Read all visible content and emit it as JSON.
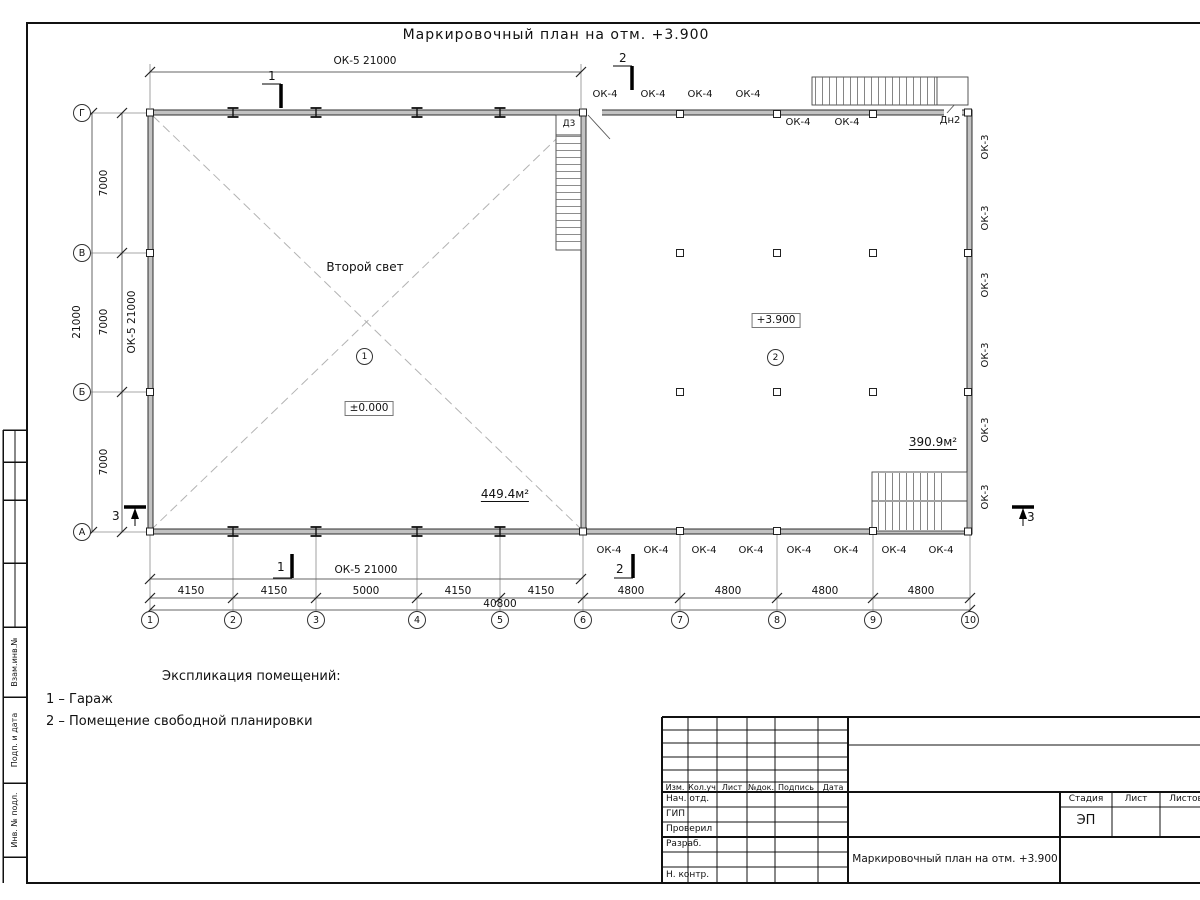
{
  "page_title": "Маркировочный план на отм. +3.900",
  "plan": {
    "axes_rows": [
      "Г",
      "В",
      "Б",
      "А"
    ],
    "axes_cols": [
      "1",
      "2",
      "3",
      "4",
      "5",
      "6",
      "7",
      "8",
      "9",
      "10"
    ],
    "dims": {
      "top_span": "ОК-5 21000",
      "bottom_span": "ОК-5 21000",
      "left_wall_mark": "ОК-5 21000",
      "left_total": "21000",
      "left_segments": [
        "7000",
        "7000",
        "7000"
      ],
      "bottom_segments": [
        "4150",
        "4150",
        "5000",
        "4150",
        "4150",
        "4800",
        "4800",
        "4800",
        "4800"
      ],
      "bottom_total": "40800"
    },
    "sections": {
      "one": "1",
      "two": "2",
      "three": "3"
    },
    "marks": {
      "ok4": "ОК-4",
      "ok3": "ОК-3",
      "d3": "Д3",
      "dn2": "Дн2"
    },
    "rooms": [
      {
        "number": "1",
        "note": "Второй свет",
        "elevation": "±0.000",
        "area": "449.4м²"
      },
      {
        "number": "2",
        "elevation": "+3.900",
        "area": "390.9м²"
      }
    ]
  },
  "legend": {
    "title": "Экспликация помещений:",
    "items": [
      "1 – Гараж",
      "2 – Помещение свободной планировки"
    ]
  },
  "titleblock": {
    "header_cols": [
      "Изм.",
      "Кол.уч",
      "Лист",
      "№док.",
      "Подпись",
      "Дата"
    ],
    "sign_rows": [
      "Нач. отд.",
      "ГИП",
      "Проверил",
      "Разраб.",
      "Н. контр."
    ],
    "stage_label": "Стадия",
    "sheet_label": "Лист",
    "sheets_label": "Листов",
    "stage_value": "ЭП",
    "doc_title": "Маркировочный план на отм. +3.900"
  },
  "side_stamp": [
    "Взам.инв.№",
    "Подп. и дата",
    "Инв. № подл."
  ]
}
